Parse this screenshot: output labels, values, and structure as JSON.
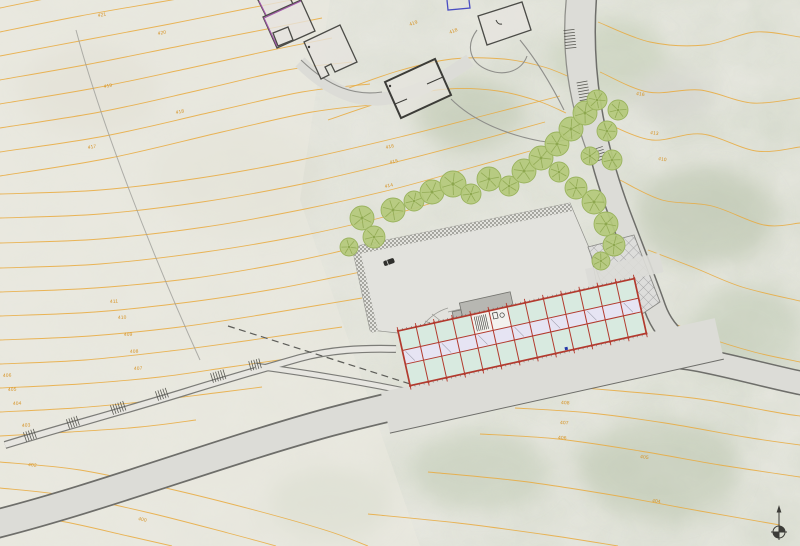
{
  "meta": {
    "drawing_type": "architectural site plan",
    "orientation_symbol": "north-arrow"
  },
  "palette": {
    "base": "#e9e9e2",
    "contour": "#e9a93c",
    "contour_label": "#d6901e",
    "road_fill": "#dcdcd7",
    "road_edge": "#6e6e6a",
    "tree_fill": "#b5c97c",
    "tree_edge": "#9ab35e",
    "tree_vein": "#8da74f",
    "plaza_fill": "#e2e2dd",
    "grid_red": "#b23a2e",
    "room_mint": "#d8eae0",
    "corridor": "#e6e4f3",
    "canopy": "#b7b7b2",
    "detail_dark": "#55554f",
    "house_edge": "#4b4b47",
    "house_accent": "#a055a8",
    "boundary_blue": "#4a4ec2",
    "north": "#3c3c38"
  },
  "plan": {
    "contours": [
      [
        [
          0,
          8
        ],
        [
          60,
          -4
        ],
        [
          130,
          -16
        ]
      ],
      [
        [
          0,
          32
        ],
        [
          80,
          16
        ],
        [
          160,
          2
        ],
        [
          230,
          -10
        ]
      ],
      [
        [
          0,
          56
        ],
        [
          85,
          40
        ],
        [
          170,
          24
        ],
        [
          250,
          8
        ],
        [
          302,
          -2
        ]
      ],
      [
        [
          0,
          80
        ],
        [
          90,
          64
        ],
        [
          180,
          46
        ],
        [
          262,
          30
        ],
        [
          322,
          18
        ]
      ],
      [
        [
          0,
          104
        ],
        [
          95,
          88
        ],
        [
          190,
          68
        ],
        [
          272,
          50
        ],
        [
          332,
          38
        ]
      ],
      [
        [
          0,
          128
        ],
        [
          100,
          112
        ],
        [
          200,
          90
        ],
        [
          287,
          70
        ],
        [
          352,
          62
        ]
      ],
      [
        [
          0,
          152
        ],
        [
          105,
          136
        ],
        [
          212,
          112
        ],
        [
          302,
          92
        ],
        [
          370,
          84
        ]
      ],
      [
        [
          0,
          176
        ],
        [
          110,
          158
        ],
        [
          222,
          132
        ],
        [
          312,
          112
        ],
        [
          382,
          104
        ]
      ],
      [
        [
          0,
          194
        ],
        [
          100,
          190
        ],
        [
          200,
          178
        ],
        [
          300,
          160
        ],
        [
          400,
          137
        ],
        [
          490,
          114
        ],
        [
          560,
          96
        ]
      ],
      [
        [
          0,
          218
        ],
        [
          100,
          214
        ],
        [
          202,
          202
        ],
        [
          302,
          184
        ],
        [
          396,
          162
        ],
        [
          480,
          140
        ],
        [
          545,
          122
        ]
      ],
      [
        [
          0,
          243
        ],
        [
          100,
          239
        ],
        [
          205,
          227
        ],
        [
          305,
          209
        ],
        [
          390,
          190
        ],
        [
          470,
          168
        ],
        [
          530,
          151
        ]
      ],
      [
        [
          0,
          268
        ],
        [
          100,
          264
        ],
        [
          205,
          252
        ],
        [
          300,
          236
        ],
        [
          376,
          219
        ],
        [
          432,
          203
        ]
      ],
      [
        [
          0,
          292
        ],
        [
          95,
          288
        ],
        [
          195,
          278
        ],
        [
          285,
          263
        ],
        [
          350,
          249
        ],
        [
          396,
          239
        ]
      ],
      [
        [
          0,
          316
        ],
        [
          95,
          312
        ],
        [
          190,
          302
        ],
        [
          275,
          289
        ],
        [
          336,
          277
        ],
        [
          380,
          268
        ]
      ],
      [
        [
          0,
          340
        ],
        [
          90,
          336
        ],
        [
          180,
          327
        ],
        [
          260,
          315
        ],
        [
          320,
          305
        ],
        [
          362,
          298
        ]
      ],
      [
        [
          0,
          364
        ],
        [
          85,
          360
        ],
        [
          170,
          351
        ],
        [
          245,
          341
        ],
        [
          300,
          333
        ],
        [
          342,
          327
        ]
      ],
      [
        [
          0,
          388
        ],
        [
          80,
          384
        ],
        [
          160,
          377
        ],
        [
          230,
          367
        ],
        [
          286,
          359
        ]
      ],
      [
        [
          0,
          412
        ],
        [
          75,
          408
        ],
        [
          150,
          401
        ],
        [
          215,
          393
        ],
        [
          262,
          387
        ]
      ],
      [
        [
          0,
          436
        ],
        [
          70,
          432
        ],
        [
          140,
          427
        ],
        [
          196,
          420
        ]
      ],
      [
        [
          0,
          462
        ],
        [
          80,
          470
        ],
        [
          170,
          489
        ],
        [
          258,
          511
        ],
        [
          328,
          531
        ],
        [
          368,
          546
        ]
      ],
      [
        [
          0,
          488
        ],
        [
          70,
          496
        ],
        [
          150,
          513
        ],
        [
          228,
          533
        ],
        [
          276,
          546
        ]
      ],
      [
        [
          0,
          514
        ],
        [
          60,
          521
        ],
        [
          128,
          536
        ],
        [
          172,
          546
        ]
      ],
      [
        [
          338,
          92
        ],
        [
          398,
          71
        ],
        [
          452,
          59
        ],
        [
          504,
          59
        ],
        [
          544,
          67
        ],
        [
          572,
          78
        ]
      ],
      [
        [
          328,
          120
        ],
        [
          392,
          99
        ],
        [
          448,
          89
        ],
        [
          498,
          91
        ],
        [
          538,
          101
        ],
        [
          566,
          113
        ]
      ],
      [
        [
          598,
          22
        ],
        [
          650,
          42
        ],
        [
          705,
          45
        ],
        [
          755,
          32
        ],
        [
          800,
          37
        ]
      ],
      [
        [
          600,
          72
        ],
        [
          648,
          92
        ],
        [
          700,
          90
        ],
        [
          752,
          103
        ],
        [
          800,
          98
        ]
      ],
      [
        [
          608,
          124
        ],
        [
          652,
          140
        ],
        [
          702,
          134
        ],
        [
          756,
          151
        ],
        [
          800,
          147
        ]
      ],
      [
        [
          620,
          180
        ],
        [
          662,
          200
        ],
        [
          712,
          206
        ],
        [
          764,
          225
        ],
        [
          800,
          223
        ]
      ],
      [
        [
          648,
          250
        ],
        [
          695,
          268
        ],
        [
          742,
          287
        ],
        [
          800,
          301
        ]
      ],
      [
        [
          662,
          318
        ],
        [
          706,
          337
        ],
        [
          754,
          352
        ],
        [
          800,
          362
        ]
      ],
      [
        [
          545,
          385
        ],
        [
          620,
          391
        ],
        [
          700,
          399
        ],
        [
          780,
          413
        ],
        [
          800,
          416
        ]
      ],
      [
        [
          515,
          408
        ],
        [
          590,
          413
        ],
        [
          665,
          423
        ],
        [
          745,
          437
        ],
        [
          800,
          445
        ]
      ],
      [
        [
          480,
          434
        ],
        [
          558,
          439
        ],
        [
          640,
          451
        ],
        [
          720,
          465
        ],
        [
          800,
          477
        ]
      ],
      [
        [
          428,
          472
        ],
        [
          520,
          481
        ],
        [
          612,
          495
        ],
        [
          700,
          511
        ],
        [
          780,
          525
        ]
      ],
      [
        [
          368,
          514
        ],
        [
          458,
          523
        ],
        [
          548,
          535
        ],
        [
          618,
          546
        ]
      ]
    ],
    "contour_labels": [
      [
        "421",
        98,
        17,
        -10
      ],
      [
        "420",
        158,
        35,
        -11
      ],
      [
        "419",
        104,
        88,
        -10
      ],
      [
        "418",
        176,
        114,
        -11
      ],
      [
        "417",
        88,
        149,
        -9
      ],
      [
        "419",
        410,
        26,
        -21
      ],
      [
        "418",
        450,
        34,
        -22
      ],
      [
        "416",
        386,
        149,
        -13
      ],
      [
        "415",
        390,
        164,
        -13
      ],
      [
        "414",
        385,
        188,
        -12
      ],
      [
        "416",
        636,
        95,
        7
      ],
      [
        "413",
        650,
        134,
        8
      ],
      [
        "410",
        658,
        160,
        9
      ],
      [
        "411",
        110,
        303,
        -3
      ],
      [
        "410",
        118,
        319,
        -3
      ],
      [
        "409",
        124,
        336,
        -3
      ],
      [
        "408",
        130,
        353,
        -3
      ],
      [
        "407",
        134,
        370,
        -3
      ],
      [
        "406",
        3,
        377,
        -2
      ],
      [
        "405",
        8,
        391,
        -2
      ],
      [
        "404",
        13,
        405,
        -3
      ],
      [
        "403",
        22,
        427,
        -4
      ],
      [
        "402",
        28,
        466,
        6
      ],
      [
        "401",
        78,
        497,
        11
      ],
      [
        "400",
        138,
        520,
        13
      ],
      [
        "409",
        564,
        377,
        4
      ],
      [
        "408",
        561,
        404,
        3
      ],
      [
        "407",
        560,
        424,
        3
      ],
      [
        "406",
        558,
        439,
        3
      ],
      [
        "405",
        640,
        458,
        7
      ],
      [
        "404",
        652,
        502,
        8
      ]
    ],
    "trees": [
      [
        349,
        247,
        9
      ],
      [
        362,
        218,
        12
      ],
      [
        374,
        237,
        11
      ],
      [
        393,
        210,
        12
      ],
      [
        414,
        201,
        10
      ],
      [
        432,
        192,
        12
      ],
      [
        453,
        184,
        13
      ],
      [
        471,
        194,
        10
      ],
      [
        489,
        179,
        12
      ],
      [
        509,
        186,
        10
      ],
      [
        524,
        171,
        12
      ],
      [
        541,
        158,
        12
      ],
      [
        557,
        144,
        12
      ],
      [
        571,
        129,
        12
      ],
      [
        585,
        113,
        12
      ],
      [
        597,
        100,
        10
      ],
      [
        559,
        172,
        10
      ],
      [
        576,
        188,
        11
      ],
      [
        594,
        202,
        12
      ],
      [
        606,
        224,
        12
      ],
      [
        614,
        245,
        11
      ],
      [
        601,
        261,
        9
      ],
      [
        590,
        156,
        9
      ],
      [
        607,
        131,
        10
      ],
      [
        612,
        160,
        10
      ],
      [
        618,
        110,
        10
      ]
    ],
    "stairs": [
      [
        25,
        437,
        -19,
        5,
        10,
        2.6
      ],
      [
        68,
        424,
        -19,
        5,
        10,
        2.6
      ],
      [
        112,
        410,
        -19,
        6,
        10,
        2.6
      ],
      [
        157,
        396,
        -19,
        5,
        10,
        2.6
      ],
      [
        212,
        378,
        -17,
        6,
        10,
        2.6
      ],
      [
        250,
        366,
        -15,
        5,
        10,
        2.6
      ],
      [
        569,
        30,
        84,
        7,
        11,
        3
      ],
      [
        582,
        82,
        80,
        7,
        11,
        3
      ],
      [
        598,
        148,
        72,
        5,
        10,
        3
      ]
    ],
    "building": {
      "x": 398,
      "y": 331,
      "angle": -12.5,
      "length": 242,
      "depth": 56,
      "bays": 13,
      "row_splits": [
        20,
        34
      ],
      "stair_bay": 4,
      "wc_bay": 5,
      "canopy": {
        "x1": 66,
        "x2": 118,
        "y1": -14,
        "y2": 2
      },
      "blue_dot": [
        159,
        52
      ],
      "apron_depth": 42
    },
    "north_arrow": {
      "x": 779,
      "y": 522
    }
  }
}
